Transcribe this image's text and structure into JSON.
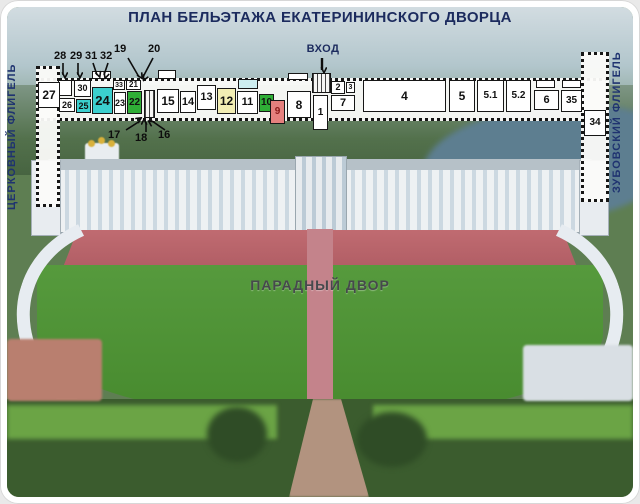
{
  "title": "ПЛАН БЕЛЬЭТАЖА ЕКАТЕРИНИНСКОГО ДВОРЦА",
  "labels": {
    "entrance": "ВХОД",
    "left_wing": "ЦЕРКОВНЫЙ ФЛИГЕЛЬ",
    "right_wing": "ЗУБОВСКИЙ ФЛИГЕЛЬ",
    "courtyard": "ПАРАДНЫЙ ДВОР"
  },
  "colors": {
    "white": "#ffffff",
    "cyan": "#3bcfce",
    "green": "#2fae36",
    "red": "#e5807e",
    "yellow": "#f2eeb4",
    "lightblue": "#cdeef0",
    "title_navy": "#1c2b5e"
  },
  "plan": {
    "rooms": [
      {
        "label": "27",
        "fill": "white"
      },
      {
        "label": "30",
        "fill": "white"
      },
      {
        "label": "26",
        "fill": "white"
      },
      {
        "label": "25",
        "fill": "cyan"
      },
      {
        "label": "24",
        "fill": "cyan"
      },
      {
        "label": "33",
        "fill": "white"
      },
      {
        "label": "21",
        "fill": "white"
      },
      {
        "label": "23",
        "fill": "white"
      },
      {
        "label": "22",
        "fill": "green"
      },
      {
        "label": "15",
        "fill": "white"
      },
      {
        "label": "14",
        "fill": "white"
      },
      {
        "label": "13",
        "fill": "white"
      },
      {
        "label": "12",
        "fill": "yellow"
      },
      {
        "label": "11",
        "fill": "white"
      },
      {
        "label": "10",
        "fill": "green"
      },
      {
        "label": "9",
        "fill": "red"
      },
      {
        "label": "8",
        "fill": "white"
      },
      {
        "label": "1",
        "fill": "white"
      },
      {
        "label": "2",
        "fill": "white"
      },
      {
        "label": "3",
        "fill": "white"
      },
      {
        "label": "7",
        "fill": "white"
      },
      {
        "label": "4",
        "fill": "white"
      },
      {
        "label": "5",
        "fill": "white"
      },
      {
        "label": "5.1",
        "fill": "white"
      },
      {
        "label": "5.2",
        "fill": "white"
      },
      {
        "label": "6",
        "fill": "white"
      },
      {
        "label": "35",
        "fill": "white"
      },
      {
        "label": "34",
        "fill": "white"
      }
    ],
    "callouts": [
      "28",
      "29",
      "31",
      "32",
      "19",
      "20",
      "17",
      "18",
      "16"
    ]
  }
}
